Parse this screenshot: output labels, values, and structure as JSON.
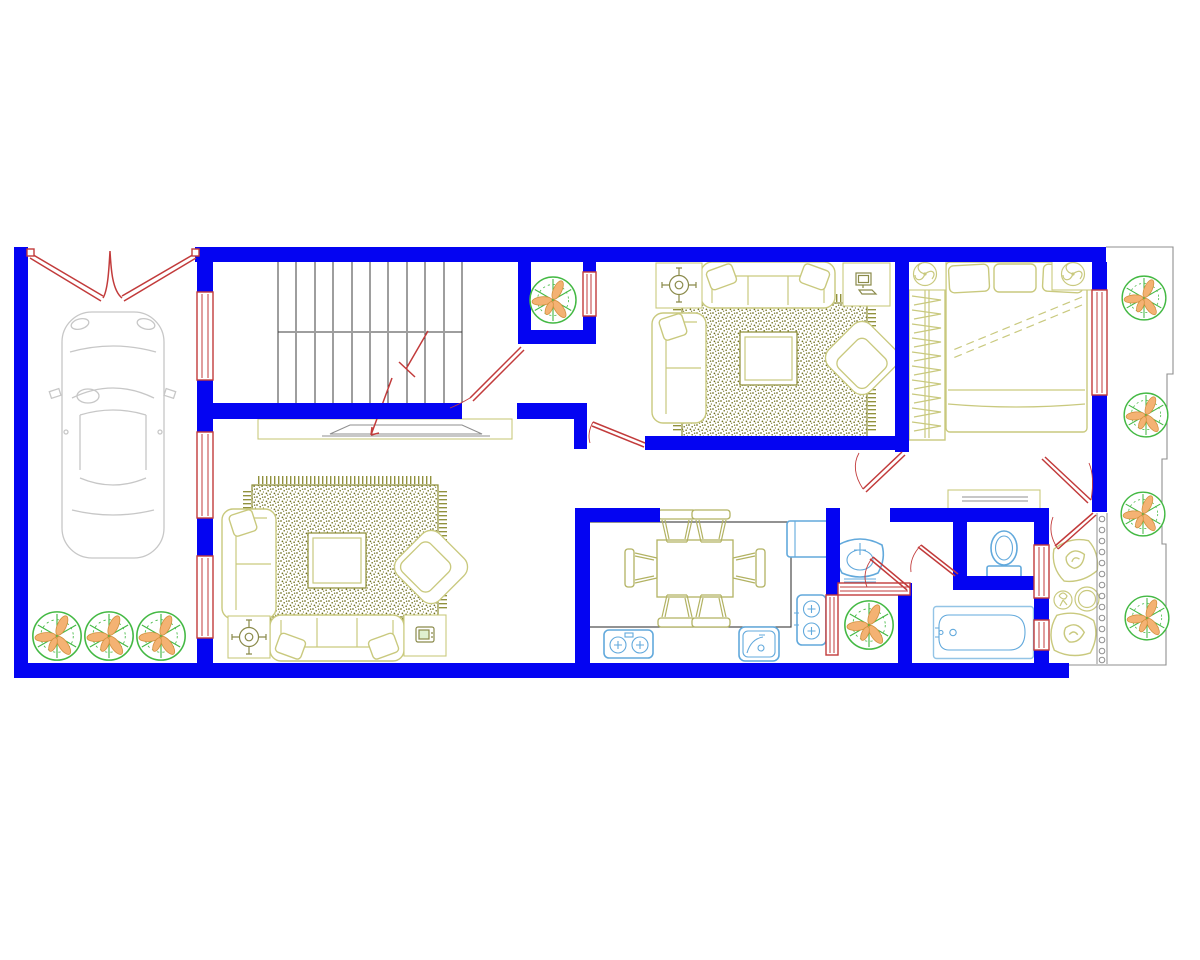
{
  "image_type": "cad-architectural-floor-plan",
  "visible_text": [],
  "palette": {
    "canvas-bg": "#ffffff",
    "wall-blue": "#0404f2",
    "door-red": "#c23b3b",
    "furniture-olive": "#c9c97e",
    "dining-olive": "#b2b262",
    "rug-olive": "#8b8b33",
    "rug-speckle": "#6f6f1f",
    "tree-green": "#44b944",
    "leaf-orange": "#f4b273",
    "petal-edge": "#d2913f",
    "fixture-cyan": "#62a9dc",
    "fixture-light": "#93c4e6",
    "car-gray": "#c7c7c7",
    "stair-gray": "#3c3c3c",
    "counter-gray": "#4a4a4a",
    "line-gray": "#8f8f8f",
    "icon-olive": "#8a8a4a"
  },
  "plan": {
    "site": {
      "property_line": "stepped thin gray line along right side and bottom-right",
      "outdoor_trees_right": 4,
      "outdoor_trees_front_yard": 3,
      "courtyard_trees": 2
    },
    "rooms": [
      {
        "name": "garage-front-yard",
        "furniture": [
          "car-top-view"
        ],
        "openings": [
          "double-leaf-gate",
          "window",
          "window",
          "window"
        ]
      },
      {
        "name": "stair-hall",
        "furniture": [
          "staircase-two-flights",
          "tv-console"
        ],
        "openings": [
          "door-to-living-room"
        ]
      },
      {
        "name": "living-room-lower",
        "furniture": [
          "speckled-rug",
          "coffee-table",
          "sofa-3-seat",
          "chaise-sofa",
          "armchair",
          "planter-stand",
          "tv-stand"
        ]
      },
      {
        "name": "light-well-1",
        "furniture": [
          "tree"
        ],
        "openings": [
          "window"
        ]
      },
      {
        "name": "living-room-upper",
        "furniture": [
          "speckled-rug",
          "coffee-table",
          "sofa-3-seat",
          "chaise-sofa",
          "armchair",
          "planter-stand",
          "computer-stand"
        ]
      },
      {
        "name": "bedroom",
        "furniture": [
          "double-bed",
          "pillow",
          "pillow",
          "pillow",
          "wardrobe-with-hangers",
          "nightstand-lamp",
          "nightstand-lamp",
          "dresser"
        ],
        "openings": [
          "door",
          "window"
        ]
      },
      {
        "name": "kitchen-dining",
        "furniture": [
          "dining-table",
          "chairs-x6",
          "counter-outline",
          "fridge",
          "gas-stove-2burner",
          "gas-stove-2burner",
          "sink"
        ]
      },
      {
        "name": "wc",
        "furniture": [
          "toilet"
        ],
        "openings": [
          "door"
        ]
      },
      {
        "name": "bathroom",
        "furniture": [
          "bathtub",
          "washbasin"
        ],
        "openings": [
          "door",
          "window",
          "window"
        ]
      },
      {
        "name": "light-well-2",
        "furniture": [
          "tree"
        ],
        "openings": [
          "window",
          "window"
        ]
      },
      {
        "name": "balcony",
        "furniture": [
          "wicker-chair",
          "wicker-chair",
          "round-table",
          "potted-plant"
        ],
        "openings": [
          "door",
          "door",
          "baluster-railing"
        ]
      }
    ],
    "counts": {
      "trees": 9,
      "door_swings": 9,
      "windows": 10,
      "wall_color_name": "blue"
    }
  }
}
